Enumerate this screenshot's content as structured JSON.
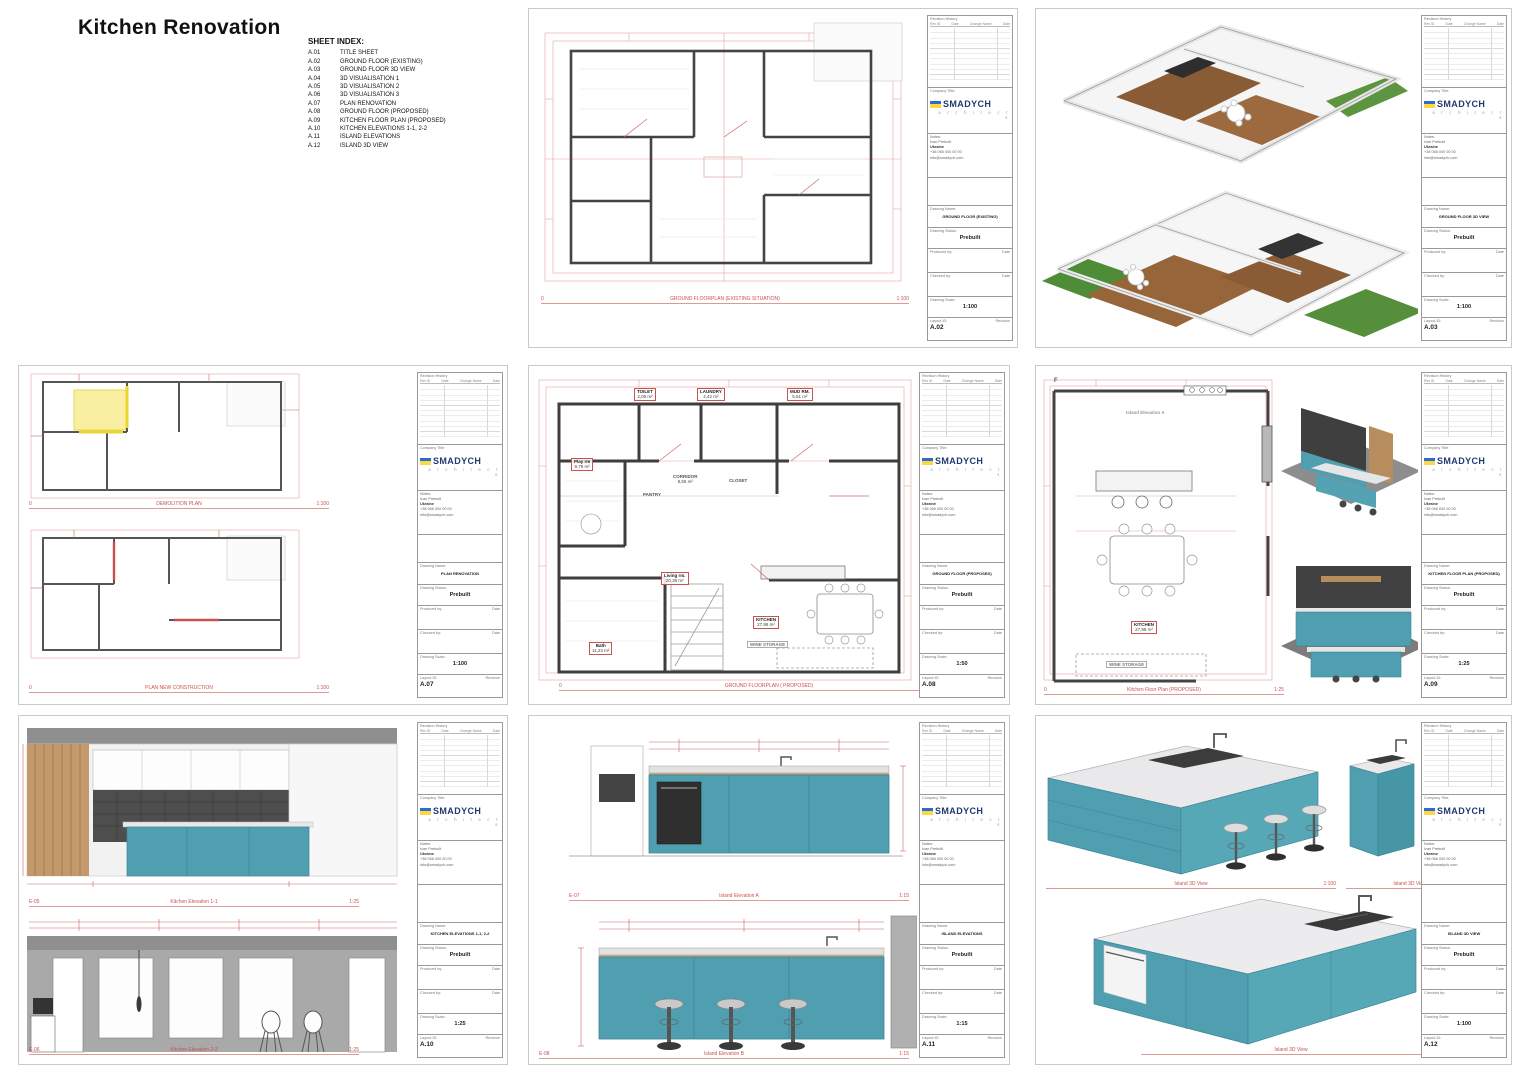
{
  "page": {
    "title": "Kitchen Renovation"
  },
  "sheet_index": {
    "heading": "SHEET INDEX:",
    "items": [
      {
        "id": "A.01",
        "label": "TITLE SHEET"
      },
      {
        "id": "A.02",
        "label": "GROUND FLOOR (EXISTING)"
      },
      {
        "id": "A.03",
        "label": "GROUND FLOOR 3D VIEW"
      },
      {
        "id": "A.04",
        "label": "3D VISUALISATION 1"
      },
      {
        "id": "A.05",
        "label": "3D VISUALISATION 2"
      },
      {
        "id": "A.06",
        "label": "3D VISUALISATION 3"
      },
      {
        "id": "A.07",
        "label": "PLAN RENOVATION"
      },
      {
        "id": "A.08",
        "label": "GROUND FLOOR (PROPOSED)"
      },
      {
        "id": "A.09",
        "label": "KITCHEN FLOOR PLAN (PROPOSED)"
      },
      {
        "id": "A.10",
        "label": "KITCHEN ELEVATIONS 1-1, 2-2"
      },
      {
        "id": "A.11",
        "label": "ISLAND ELEVATIONS"
      },
      {
        "id": "A.12",
        "label": "ISLAND 3D VIEW"
      }
    ]
  },
  "title_block": {
    "revision_history_label": "Revision History",
    "rev_cols": [
      "Rev ID",
      "Date",
      "Change Name",
      "Date"
    ],
    "company_title_label": "Company Title:",
    "company_name": "SMADYCH",
    "company_sub": "a r c h i t e c t s",
    "contact_label": "Notes:",
    "contact_lines": [
      "Ivan Prebuilt",
      "Ukraine",
      "+38 066 000 00 00",
      "info@smadych.com"
    ],
    "drawing_name_label": "Drawing Name:",
    "drawing_status_label": "Drawing Status:",
    "status": "Prebuilt",
    "produced_by_label": "Produced by:",
    "checked_by_label": "Checked by:",
    "date_label": "Date",
    "drawing_scale_label": "Drawing Scale:",
    "layout_id_label": "Layout ID:",
    "revision_label": "Revision"
  },
  "sheets": {
    "a02": {
      "drawing_name": "GROUND FLOOR (EXISTING)",
      "scale": "1:100",
      "layout_id": "A.02",
      "captions": [
        {
          "prefix": "0",
          "title": "GROUND FLOORPLAN (EXISTING SITUATION)",
          "scale": "1:100"
        }
      ]
    },
    "a03": {
      "drawing_name": "GROUND FLOOR 3D VIEW",
      "scale": "1:100",
      "layout_id": "A.03",
      "captions": []
    },
    "a07": {
      "drawing_name": "PLAN RENOVATION",
      "scale": "1:100",
      "layout_id": "A.07",
      "captions": [
        {
          "prefix": "0",
          "title": "DEMOLITION PLAN",
          "scale": "1:100"
        },
        {
          "prefix": "0",
          "title": "PLAN NEW CONSTRUCTION",
          "scale": "1:100"
        }
      ]
    },
    "a08": {
      "drawing_name": "GROUND FLOOR (PROPOSED)",
      "scale": "1:50",
      "layout_id": "A.08",
      "captions": [
        {
          "prefix": "0",
          "title": "GROUND FLOORPLAN ( PROPOSED)",
          "scale": "1:50"
        }
      ],
      "rooms": [
        {
          "name": "TOILET",
          "area": "2,06 m²"
        },
        {
          "name": "LAUNDRY",
          "area": "4,42 m²"
        },
        {
          "name": "MUD RM.",
          "area": "5,51 m²"
        },
        {
          "name": "Play rm",
          "area": "9,79 m²"
        },
        {
          "name": "CORRIDOR",
          "area": "8,55 m²"
        },
        {
          "name": "PANTRY",
          "area": ""
        },
        {
          "name": "CLOSET",
          "area": ""
        },
        {
          "name": "Living rm.",
          "area": "20,39 m²"
        },
        {
          "name": "Bath",
          "area": "11,23 m²"
        },
        {
          "name": "KITCHEN",
          "area": "27,98 m²"
        },
        {
          "name": "WINE STORAGE",
          "area": ""
        }
      ]
    },
    "a09": {
      "drawing_name": "KITCHEN FLOOR PLAN (PROPOSED)",
      "scale": "1:25",
      "layout_id": "A.09",
      "captions": [
        {
          "prefix": "0",
          "title": "Kitchen Floor Plan (PROPOSED)",
          "scale": "1:25"
        }
      ],
      "rooms": [
        {
          "name": "KITCHEN",
          "area": "27,98 m²"
        },
        {
          "name": "WINE STORAGE",
          "area": ""
        }
      ],
      "marker": "F",
      "elev_marker": "Island Elevation A"
    },
    "a10": {
      "drawing_name": "KITCHEN ELEVATIONS 1-1, 2-2",
      "scale": "1:25",
      "layout_id": "A.10",
      "captions": [
        {
          "prefix": "E-05",
          "title": "Kitchen Elevation 1-1",
          "scale": "1:25"
        },
        {
          "prefix": "E-06",
          "title": "Kitchen Elevation 2-2",
          "scale": "1:25"
        }
      ]
    },
    "a11": {
      "drawing_name": "ISLAND ELEVATIONS",
      "scale": "1:15",
      "layout_id": "A.11",
      "captions": [
        {
          "prefix": "E-07",
          "title": "Island Elevation A",
          "scale": "1:15"
        },
        {
          "prefix": "E-08",
          "title": "Island Elevation B",
          "scale": "1:15"
        }
      ]
    },
    "a12": {
      "drawing_name": "ISLAND 3D VIEW",
      "scale": "1:100",
      "layout_id": "A.12",
      "captions": [
        {
          "prefix": "",
          "title": "Island 3D View",
          "scale": "1:100"
        },
        {
          "prefix": "",
          "title": "Island 3D View",
          "scale": "1:100"
        },
        {
          "prefix": "",
          "title": "Island 3D View",
          "scale": "1:100"
        }
      ]
    }
  }
}
